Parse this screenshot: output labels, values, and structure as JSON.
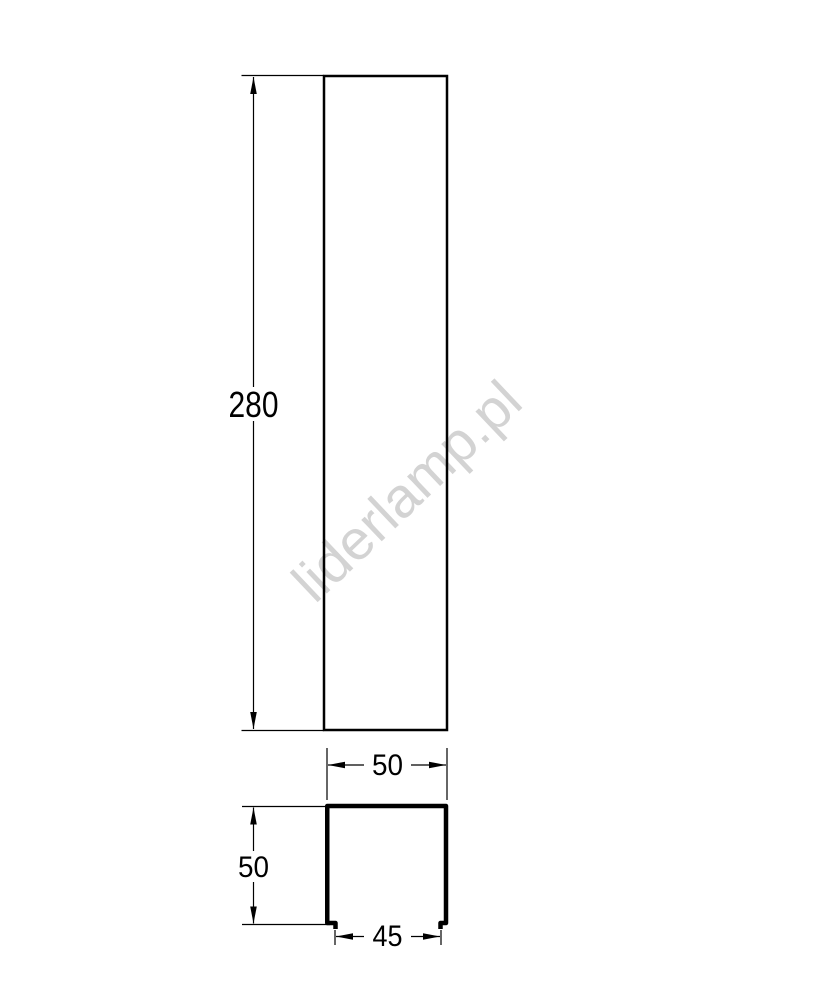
{
  "drawing": {
    "watermark": {
      "text": "liderlamp.pl",
      "color": "#d3d3d3"
    },
    "front_view": {
      "height_dim": "280"
    },
    "cross_section": {
      "outer_width_dim": "50",
      "height_dim": "50",
      "opening_width_dim": "45"
    },
    "colors": {
      "line": "#000000",
      "background": "#ffffff"
    }
  }
}
